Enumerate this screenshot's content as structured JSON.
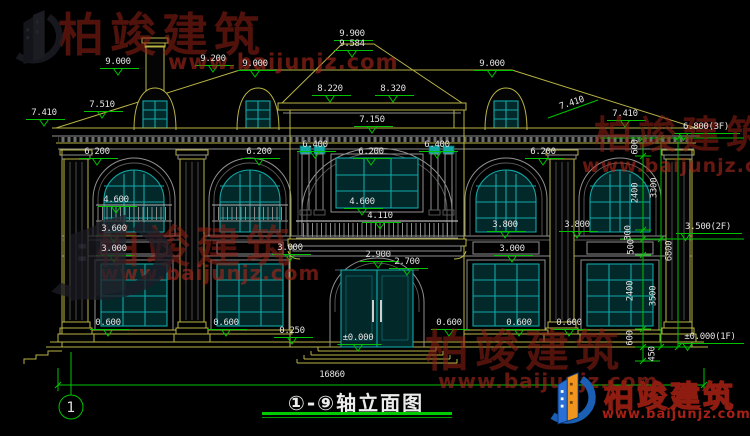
{
  "title_block": {
    "text": "①-⑨轴立面图"
  },
  "grid_bubble": {
    "label": "1"
  },
  "watermark": {
    "cn": "柏竣建筑",
    "url": "www.baijunjz.com"
  },
  "logo": {
    "cn": "柏竣建筑",
    "url": "www.baijunjz.com"
  },
  "colors": {
    "background": "#000000",
    "linework_yellow": "#b9b345",
    "dimension_green": "#00c300",
    "dimension_text": "#e2e2e2",
    "window_teal": "#12a8a8",
    "watermark_red": "#962016",
    "logo_blue": "#1a5fb4",
    "logo_orange": "#f1951f"
  },
  "floor_levels": [
    "6.800(3F)",
    "3.500(2F)",
    "±0.000(1F)"
  ],
  "overall_width_dim": "16860",
  "annotations": [
    {
      "t": "9.900",
      "x": 352,
      "y": 30,
      "m": "u"
    },
    {
      "t": "9.584",
      "x": 352,
      "y": 40,
      "m": "v"
    },
    {
      "t": "9.000",
      "x": 118,
      "y": 58,
      "m": "v"
    },
    {
      "t": "9.200",
      "x": 213,
      "y": 55,
      "m": "v"
    },
    {
      "t": "9.000",
      "x": 255,
      "y": 60,
      "m": "v"
    },
    {
      "t": "9.000",
      "x": 492,
      "y": 60,
      "m": "v"
    },
    {
      "t": "8.220",
      "x": 330,
      "y": 85,
      "m": "v"
    },
    {
      "t": "8.320",
      "x": 393,
      "y": 85,
      "m": "v"
    },
    {
      "t": "7.150",
      "x": 372,
      "y": 116,
      "m": "v"
    },
    {
      "t": "7.410",
      "x": 44,
      "y": 109,
      "m": "v"
    },
    {
      "t": "7.510",
      "x": 102,
      "y": 101,
      "m": "v"
    },
    {
      "t": "7.410",
      "x": 572,
      "y": 104,
      "rot": -18,
      "m": "n"
    },
    {
      "t": "7.410",
      "x": 625,
      "y": 110,
      "m": "v"
    },
    {
      "t": "6.800(3F)",
      "x": 706,
      "y": 123,
      "m": "e"
    },
    {
      "t": "6.200",
      "x": 97,
      "y": 148,
      "m": "v"
    },
    {
      "t": "6.200",
      "x": 259,
      "y": 148,
      "m": "v"
    },
    {
      "t": "6.400",
      "x": 315,
      "y": 141,
      "m": "v"
    },
    {
      "t": "6.200",
      "x": 371,
      "y": 148,
      "m": "v"
    },
    {
      "t": "6.400",
      "x": 437,
      "y": 141,
      "m": "v"
    },
    {
      "t": "6.200",
      "x": 543,
      "y": 148,
      "m": "v"
    },
    {
      "t": "4.600",
      "x": 116,
      "y": 196,
      "m": "v"
    },
    {
      "t": "4.600",
      "x": 362,
      "y": 198,
      "m": "v"
    },
    {
      "t": "4.110",
      "x": 380,
      "y": 212,
      "m": "v"
    },
    {
      "t": "3.600",
      "x": 114,
      "y": 225,
      "m": "v"
    },
    {
      "t": "3.000",
      "x": 114,
      "y": 245,
      "m": "v"
    },
    {
      "t": "3.000",
      "x": 290,
      "y": 244,
      "m": "v"
    },
    {
      "t": "3.800",
      "x": 505,
      "y": 221,
      "m": "v"
    },
    {
      "t": "3.800",
      "x": 577,
      "y": 221,
      "m": "v"
    },
    {
      "t": "3.000",
      "x": 512,
      "y": 245,
      "m": "v"
    },
    {
      "t": "2.900",
      "x": 378,
      "y": 251,
      "m": "v"
    },
    {
      "t": "2.700",
      "x": 407,
      "y": 258,
      "m": "v"
    },
    {
      "t": "0.600",
      "x": 108,
      "y": 319,
      "m": "v"
    },
    {
      "t": "0.600",
      "x": 226,
      "y": 319,
      "m": "v"
    },
    {
      "t": "0.250",
      "x": 292,
      "y": 327,
      "m": "v"
    },
    {
      "t": "±0.000",
      "x": 358,
      "y": 334,
      "m": "v"
    },
    {
      "t": "0.600",
      "x": 449,
      "y": 319,
      "m": "v"
    },
    {
      "t": "0.600",
      "x": 519,
      "y": 319,
      "m": "v"
    },
    {
      "t": "0.600",
      "x": 569,
      "y": 319,
      "m": "v"
    },
    {
      "t": "3.500(2F)",
      "x": 708,
      "y": 223,
      "m": "e"
    },
    {
      "t": "±0.000(1F)",
      "x": 710,
      "y": 333,
      "m": "e"
    },
    {
      "t": "16860",
      "x": 332,
      "y": 371,
      "m": "n"
    },
    {
      "t": "600",
      "x": 636,
      "y": 147,
      "rot": -90,
      "m": "n"
    },
    {
      "t": "2400",
      "x": 636,
      "y": 193,
      "rot": -90,
      "m": "n"
    },
    {
      "t": "3300",
      "x": 655,
      "y": 188,
      "rot": -90,
      "m": "n"
    },
    {
      "t": "300",
      "x": 629,
      "y": 233,
      "rot": -90,
      "m": "n"
    },
    {
      "t": "500",
      "x": 632,
      "y": 247,
      "rot": -90,
      "m": "n"
    },
    {
      "t": "2400",
      "x": 631,
      "y": 291,
      "rot": -90,
      "m": "n"
    },
    {
      "t": "3500",
      "x": 654,
      "y": 296,
      "rot": -90,
      "m": "n"
    },
    {
      "t": "6800",
      "x": 670,
      "y": 251,
      "rot": -90,
      "m": "n"
    },
    {
      "t": "600",
      "x": 631,
      "y": 338,
      "rot": -90,
      "m": "n"
    },
    {
      "t": "450",
      "x": 653,
      "y": 354,
      "rot": -90,
      "m": "n"
    }
  ]
}
